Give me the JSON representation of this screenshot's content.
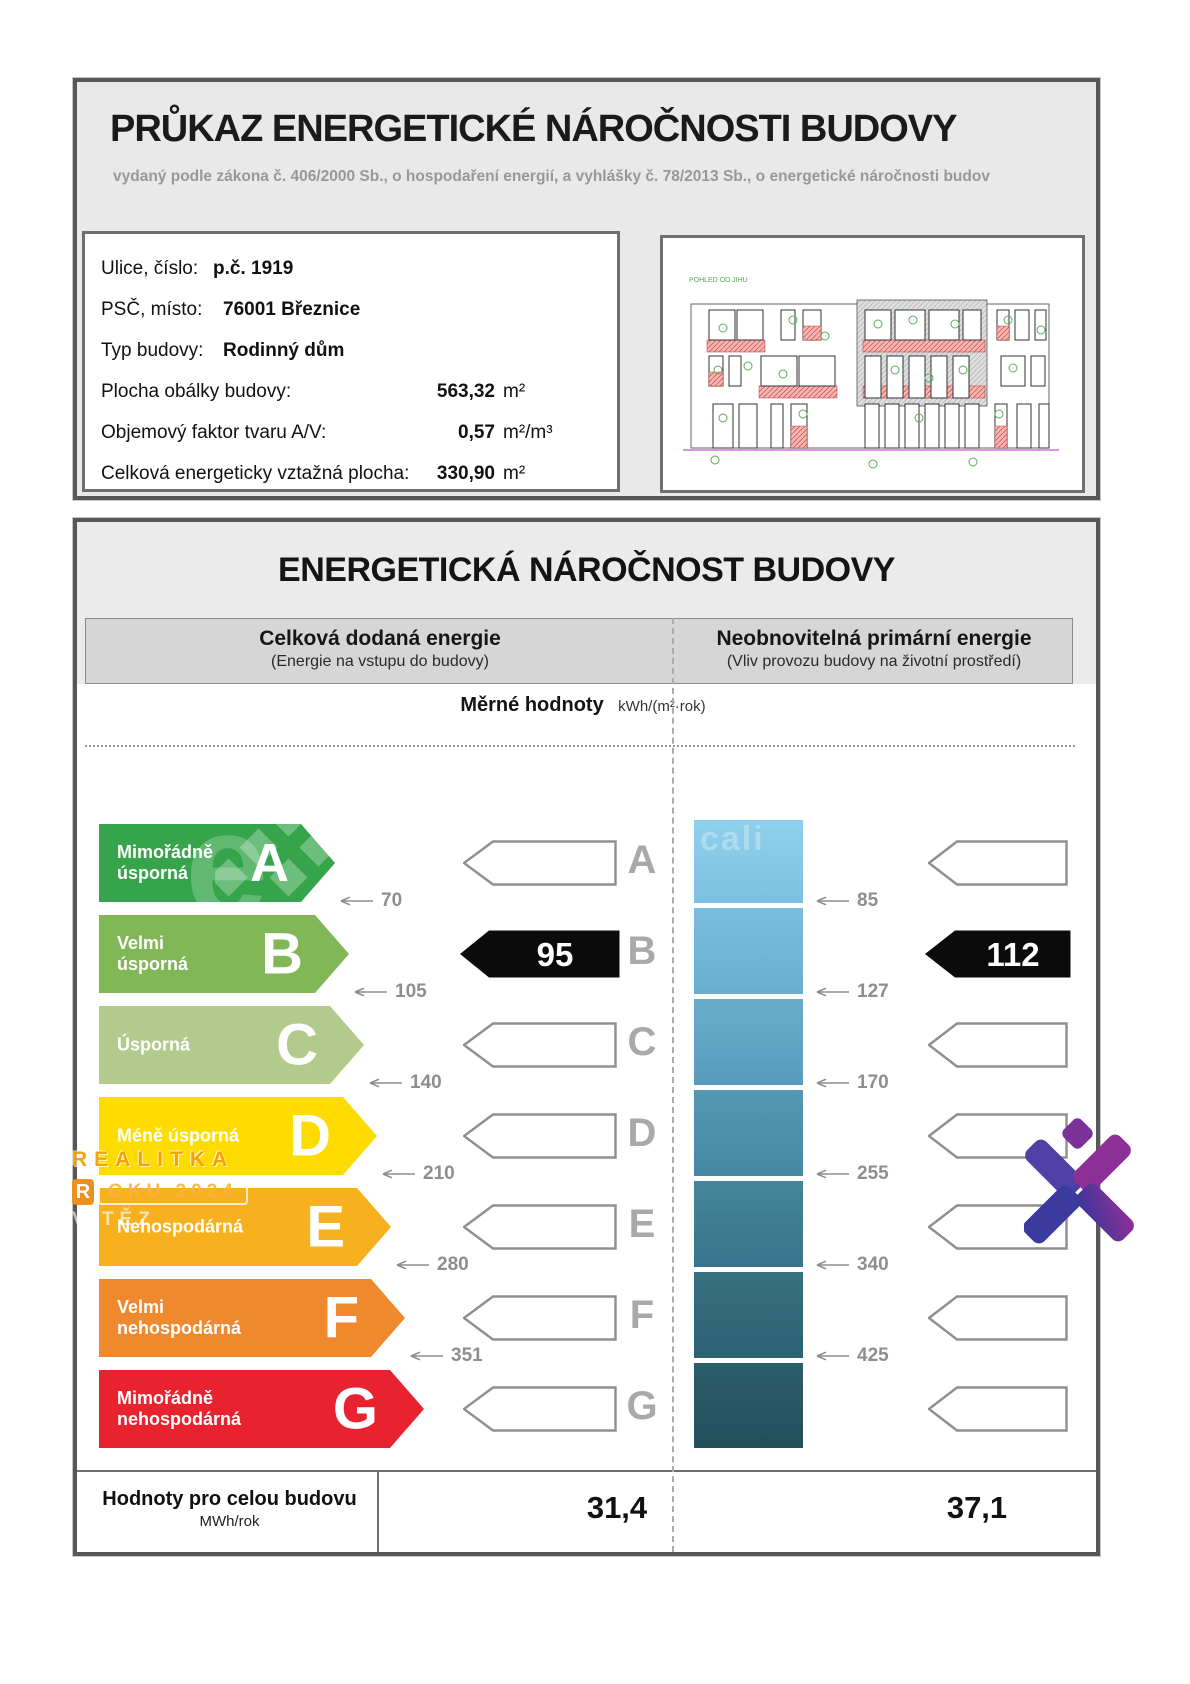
{
  "certificate": {
    "title": "PRŮKAZ ENERGETICKÉ NÁROČNOSTI BUDOVY",
    "subtitle": "vydaný podle zákona č. 406/2000 Sb., o hospodaření energií, a vyhlášky č. 78/2013 Sb., o energetické náročnosti budov",
    "info": [
      {
        "label": "Ulice, číslo:",
        "value": "p.č. 1919",
        "unit": ""
      },
      {
        "label": "PSČ, místo:",
        "value": "76001 Březnice",
        "unit": ""
      },
      {
        "label": "Typ budovy:",
        "value": "Rodinný dům",
        "unit": ""
      },
      {
        "label": "Plocha obálky budovy:",
        "value": "563,32",
        "unit": "m²"
      },
      {
        "label": "Objemový faktor tvaru A/V:",
        "value": "0,57",
        "unit": "m²/m³"
      },
      {
        "label": "Celková energeticky vztažná plocha:",
        "value": "330,90",
        "unit": "m²"
      }
    ],
    "drawing_caption": "POHLED OD JIHU"
  },
  "section": {
    "title": "ENERGETICKÁ NÁROČNOST BUDOVY",
    "columns": {
      "left": {
        "title": "Celková dodaná energie",
        "subtitle": "(Energie na vstupu do budovy)"
      },
      "right": {
        "title": "Neobnovitelná primární energie",
        "subtitle": "(Vliv provozu budovy na životní prostředí)"
      }
    },
    "units_label": "Měrné hodnoty",
    "units": "kWh/(m²·rok)"
  },
  "scale": {
    "rows": [
      {
        "letter": "A",
        "label": "Mimořádně\núsporná",
        "color": "#35a44a",
        "width": 236
      },
      {
        "letter": "B",
        "label": "Velmi\núsporná",
        "color": "#82b757",
        "width": 250
      },
      {
        "letter": "C",
        "label": "Úsporná",
        "color": "#b2cb8d",
        "width": 265
      },
      {
        "letter": "D",
        "label": "Méně úsporná",
        "color": "#ffdc00",
        "width": 278
      },
      {
        "letter": "E",
        "label": "Nehospodárná",
        "color": "#f8b11e",
        "width": 292
      },
      {
        "letter": "F",
        "label": "Velmi\nnehospodárná",
        "color": "#f0882e",
        "width": 306
      },
      {
        "letter": "G",
        "label": "Mimořádně\nnehospodárná",
        "color": "#e8232f",
        "width": 325
      }
    ],
    "left_thresholds": [
      "70",
      "105",
      "140",
      "210",
      "280",
      "351"
    ],
    "right_thresholds": [
      "85",
      "127",
      "170",
      "255",
      "340",
      "425"
    ],
    "blue_gradients": [
      [
        "#8fd0ec",
        "#7cc1e1"
      ],
      [
        "#79bedd",
        "#68aecf"
      ],
      [
        "#68adcb",
        "#579cbc"
      ],
      [
        "#5698b3",
        "#4687a3"
      ],
      [
        "#468599",
        "#38748b"
      ],
      [
        "#37707f",
        "#2c6274"
      ],
      [
        "#2b5d6b",
        "#234f5c"
      ]
    ]
  },
  "ratings": {
    "delivered": "95",
    "primary": "112",
    "class_row": 1
  },
  "totals": {
    "label": "Hodnoty pro celou budovu",
    "unit": "MWh/rok",
    "delivered": "31,4",
    "primary": "37,1"
  },
  "watermarks": {
    "letter_e": "e",
    "blue_text": "cali",
    "line1": "REALITKA",
    "line2_chip": "R",
    "line2": "OKU 2024",
    "line3": "VÍTĚZ"
  },
  "chart_data": {
    "type": "table",
    "title": "Energetická náročnost budovy — klasifikace",
    "classes": [
      "A",
      "B",
      "C",
      "D",
      "E",
      "F",
      "G"
    ],
    "class_labels": [
      "Mimořádně úsporná",
      "Velmi úsporná",
      "Úsporná",
      "Méně úsporná",
      "Nehospodárná",
      "Velmi nehospodárná",
      "Mimořádně nehospodárná"
    ],
    "delivered_energy_thresholds_kwh_m2yr": [
      70,
      105,
      140,
      210,
      280,
      351
    ],
    "primary_energy_thresholds_kwh_m2yr": [
      85,
      127,
      170,
      255,
      340,
      425
    ],
    "building_delivered_energy_kwh_m2yr": 95,
    "building_primary_energy_kwh_m2yr": 112,
    "building_class": "B",
    "totals_mwh_per_year": {
      "delivered": 31.4,
      "primary": 37.1
    }
  }
}
